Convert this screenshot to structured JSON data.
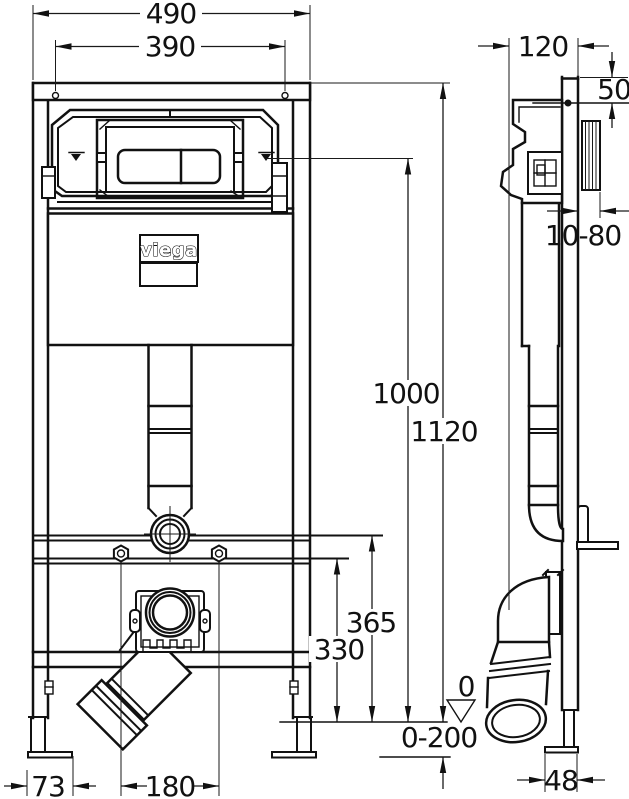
{
  "drawing": {
    "brand_logo": "viega",
    "labels": {
      "d490": "490",
      "d390": "390",
      "d120": "120",
      "d50": "50",
      "d10_80": "10-80",
      "d1000": "1000",
      "d1120": "1120",
      "d365": "365",
      "d330": "330",
      "d0": "0",
      "d0_200": "0-200",
      "d73": "73",
      "d180": "180",
      "d48": "48"
    },
    "line_color": "#111111",
    "background": "#ffffff"
  }
}
